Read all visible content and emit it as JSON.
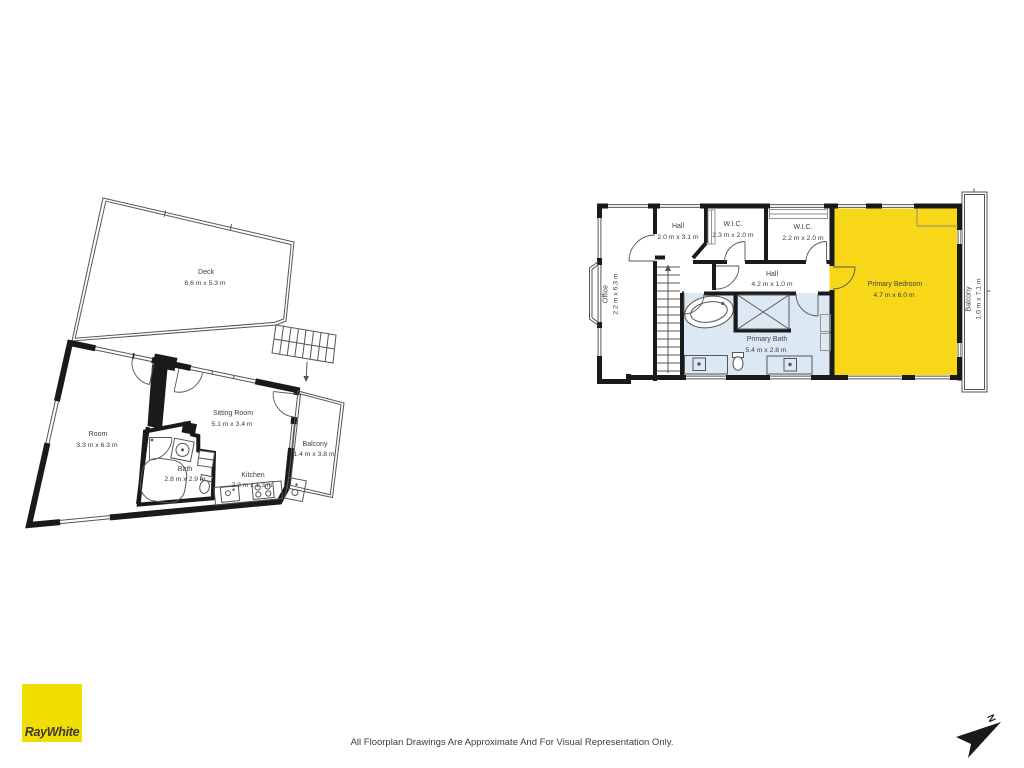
{
  "branding": {
    "logo_text": "RayWhite",
    "logo_color": "#F1DE00"
  },
  "footer": {
    "disclaimer": "All Floorplan Drawings Are Approximate And For Visual Representation Only."
  },
  "compass": {
    "label": "N"
  },
  "colors": {
    "wall": "#1A1A1A",
    "highlight_yellow": "#F7D717",
    "bath_blue": "#DCE9F5",
    "logo": "#F1DE00",
    "line": "#555555",
    "text": "#3E3E3E"
  },
  "floorplans": {
    "lower": {
      "rooms": [
        {
          "id": "deck",
          "name": "Deck",
          "dims": "8.6 m x 5.3 m"
        },
        {
          "id": "room",
          "name": "Room",
          "dims": "3.3 m x 6.3 m"
        },
        {
          "id": "sitting-room",
          "name": "Sitting Room",
          "dims": "5.1 m x 3.4 m"
        },
        {
          "id": "bath",
          "name": "Bath",
          "dims": "2.8 m x 2.9 m"
        },
        {
          "id": "kitchen",
          "name": "Kitchen",
          "dims": "2.3 m x 1.3 m"
        },
        {
          "id": "balcony",
          "name": "Balcony",
          "dims": "1.4 m x 3.8 m"
        }
      ]
    },
    "upper": {
      "rooms": [
        {
          "id": "office",
          "name": "Office",
          "dims": "2.2 m x 6.3 m"
        },
        {
          "id": "hall-top",
          "name": "Hall",
          "dims": "2.0 m x 3.1 m"
        },
        {
          "id": "wic-1",
          "name": "W.I.C.",
          "dims": "2.3 m x 2.0 m"
        },
        {
          "id": "wic-2",
          "name": "W.I.C.",
          "dims": "2.2 m x 2.0 m"
        },
        {
          "id": "hall-mid",
          "name": "Hall",
          "dims": "4.2 m x 1.0 m"
        },
        {
          "id": "primary-bath",
          "name": "Primary Bath",
          "dims": "5.4 m x 2.8 m"
        },
        {
          "id": "primary-bedroom",
          "name": "Primary Bedroom",
          "dims": "4.7 m x 6.0 m"
        },
        {
          "id": "balcony",
          "name": "Balcony",
          "dims": "1.0 m x 7.1 m"
        }
      ]
    }
  }
}
